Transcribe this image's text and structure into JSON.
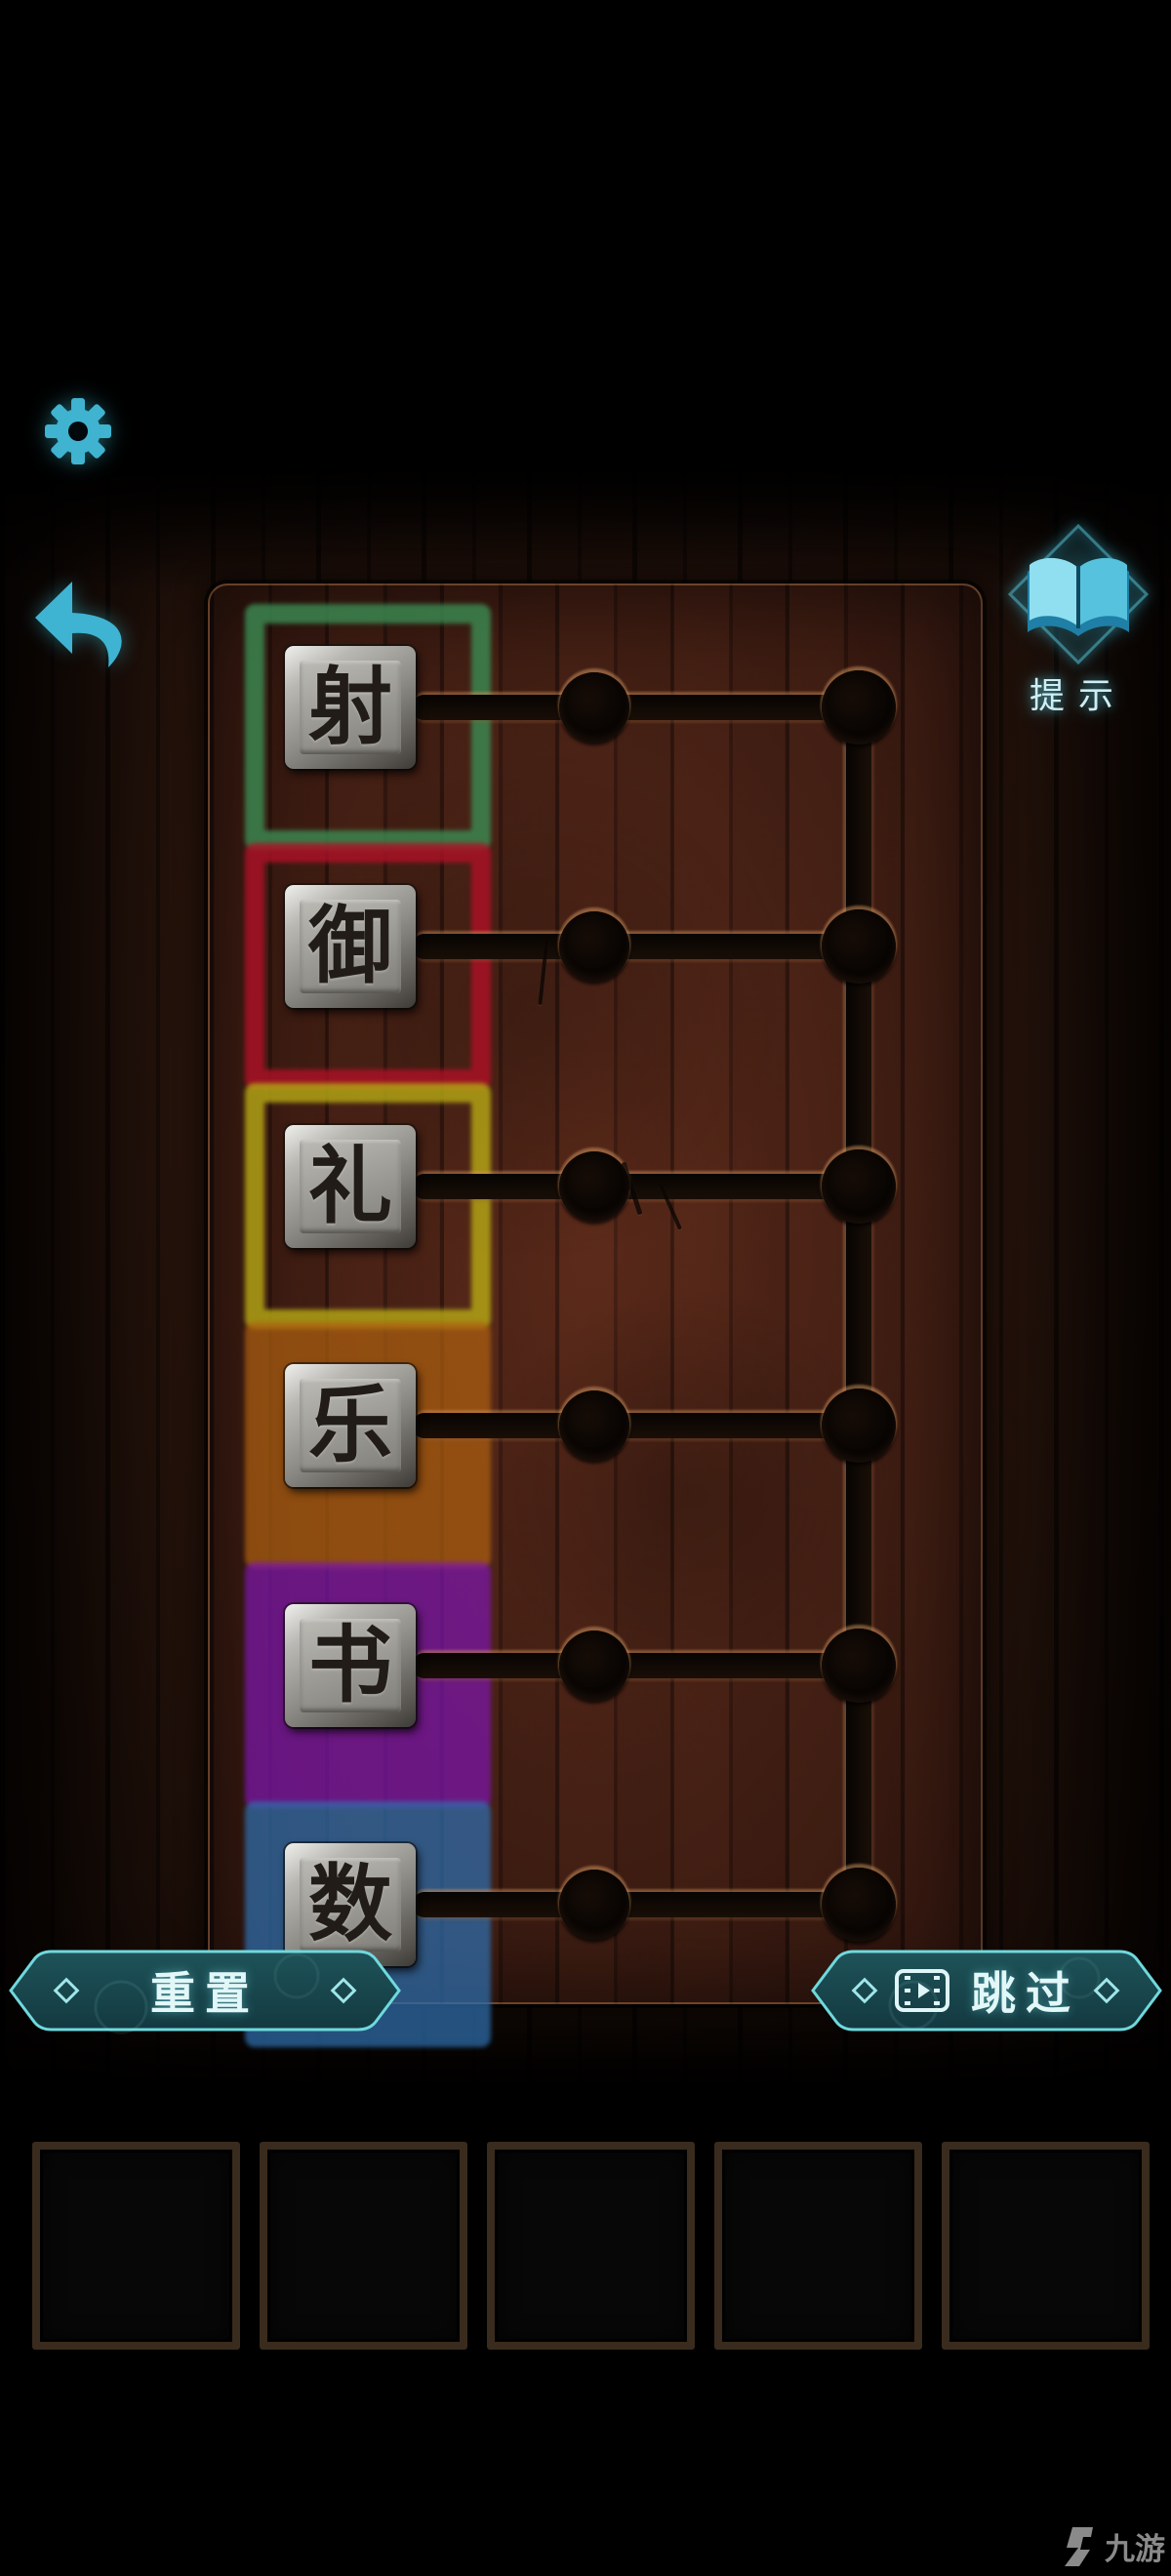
{
  "hud": {
    "settings_icon": "gear-icon",
    "back_icon": "back-arrow-icon",
    "hint": {
      "label": "提示",
      "icon": "open-book-icon"
    }
  },
  "board": {
    "tiles": [
      {
        "char": "射",
        "chalk_color": "#3c8a52",
        "chalk_style": "outline"
      },
      {
        "char": "御",
        "chalk_color": "#ad1127",
        "chalk_style": "outline"
      },
      {
        "char": "礼",
        "chalk_color": "#b5a715",
        "chalk_style": "outline"
      },
      {
        "char": "乐",
        "chalk_color": "#ad5f10",
        "chalk_style": "filled"
      },
      {
        "char": "书",
        "chalk_color": "#7d16ad",
        "chalk_style": "filled"
      },
      {
        "char": "数",
        "chalk_color": "#2f6fae",
        "chalk_style": "filled"
      }
    ]
  },
  "footer": {
    "reset_label": "重置",
    "skip_label": "跳过",
    "skip_icon": "film-icon"
  },
  "inventory": {
    "slot_count": 5
  },
  "watermark": {
    "text": "九游"
  },
  "colors": {
    "accent_teal": "#45bcd2",
    "button_fill": "#1b4c52",
    "button_border": "#6fd9dd",
    "board_wood": "#451f15",
    "groove": "#0d0703"
  }
}
